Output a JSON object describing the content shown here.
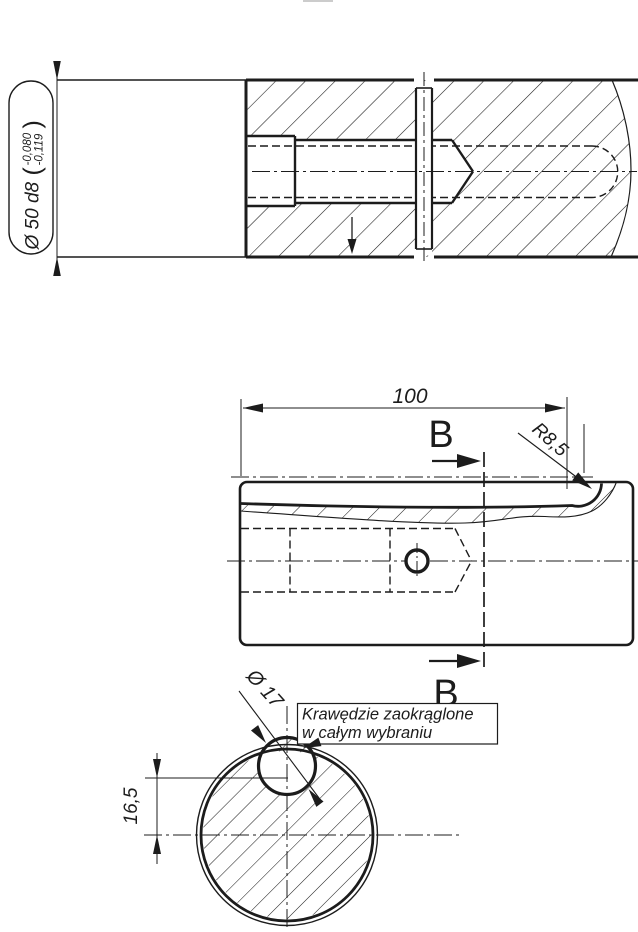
{
  "colors": {
    "ink": "#1c1c1c",
    "background": "#ffffff"
  },
  "views": {
    "longitudinal_section": {
      "balloon": {
        "main": "Ø 50 d8",
        "paren_open": "(",
        "tol_upper": "-0,080",
        "tol_lower": "-0,119",
        "paren_close": ")"
      }
    },
    "side_view": {
      "length_dim": "100",
      "radius_label": "R8,5",
      "section_label_top": "B",
      "section_label_bottom": "B"
    },
    "section_bb": {
      "hole_dia_label": "Ø 17",
      "depth_dim": "16,5",
      "note_line1": "Krawędzie zaokrąglone",
      "note_line2": "w całym wybraniu"
    }
  }
}
